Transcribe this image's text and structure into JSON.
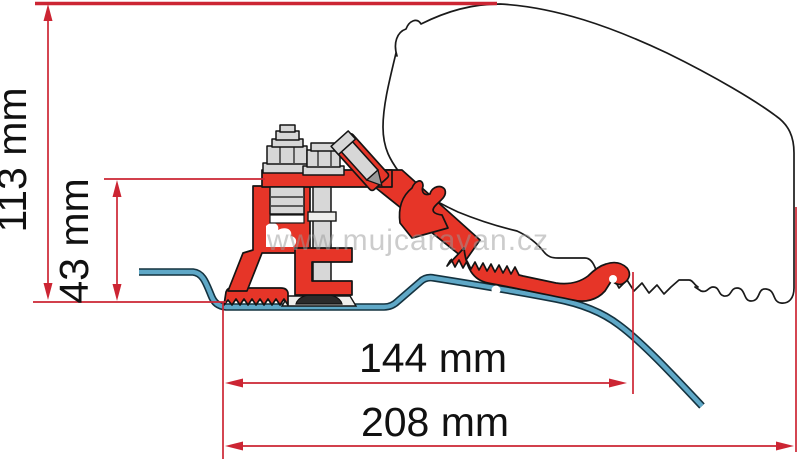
{
  "diagram": {
    "title": "awning-adapter-cross-section",
    "dimensions": {
      "total_height": "113 mm",
      "bracket_height": "43 mm",
      "inner_width": "144 mm",
      "total_width": "208 mm"
    },
    "watermark": "www.mujcaravan.cz",
    "colors": {
      "bracket_red": "#e63528",
      "dimension_red": "#cc2533",
      "roof_sheet_blue": "#5fa8c7",
      "hardware_gray": "#d7d7d7",
      "outline_black": "#1a1a1a",
      "watermark_gray": "#9a9a9a"
    }
  }
}
